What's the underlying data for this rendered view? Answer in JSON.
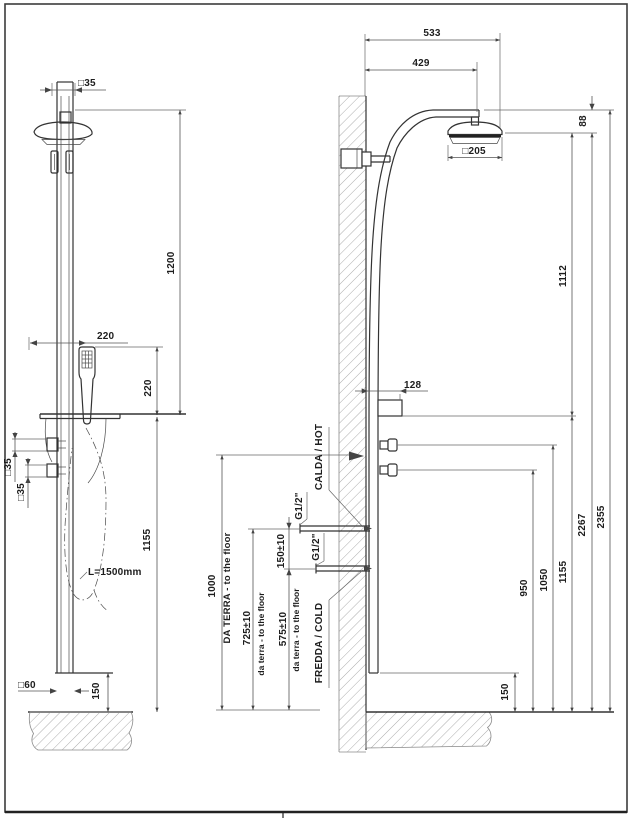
{
  "front_view": {
    "pole_square": "□35",
    "head_to_shelf": "1200",
    "handshower_offset": "220",
    "handshower_height": "220",
    "knob1_square": "□35",
    "knob2_square": "□35",
    "shelf_to_floor": "1155",
    "base_square": "□60",
    "base_height": "150",
    "hose_length": "L=1500mm"
  },
  "side_view": {
    "arm_total": "533",
    "arm_reach": "429",
    "head_thickness": "88",
    "head_square": "□205",
    "head_to_shelf": "1112",
    "shelf_depth": "128",
    "head_to_floor": "2267",
    "total_height": "2355",
    "knob_low_height": "950",
    "knob_high_height": "1050",
    "shelf_height": "1155",
    "base_height": "150",
    "hot_outlet_height": "1000",
    "hot_conn_height": "725±10",
    "cold_conn_height": "575±10",
    "conn_gap": "150±10",
    "thread_hot": "G1/2\"",
    "thread_cold": "G1/2\"",
    "hot_label": "CALDA / HOT",
    "cold_label": "FREDDA / COLD",
    "floor_note_caps": "DA TERRA - to the floor",
    "floor_note_mid": "da terra - to the floor",
    "floor_note_low": "da terra - to the floor"
  }
}
